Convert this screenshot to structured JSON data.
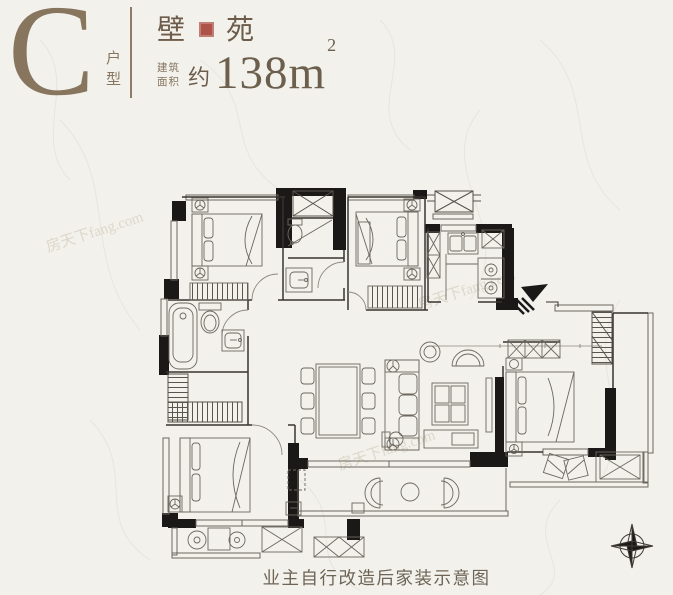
{
  "header": {
    "unit_letter": "C",
    "unit_type_label": "户型",
    "name_char_1": "壁",
    "name_char_2": "苑",
    "area_label_1": "建筑",
    "area_label_2": "面积",
    "area_prefix": "约",
    "area_number": "138",
    "area_unit": "m",
    "area_sup": "2"
  },
  "footer": {
    "caption": "业主自行改造后家装示意图"
  },
  "watermark": {
    "text": "房天下fang.com"
  },
  "colors": {
    "background": "#f2f1ec",
    "accent_brown": "#87755e",
    "title_brown": "#6d5c49",
    "seal_red": "#ad5347",
    "wall_black": "#1b1918",
    "plan_line": "#57524a",
    "footer_text": "#6e6456"
  }
}
